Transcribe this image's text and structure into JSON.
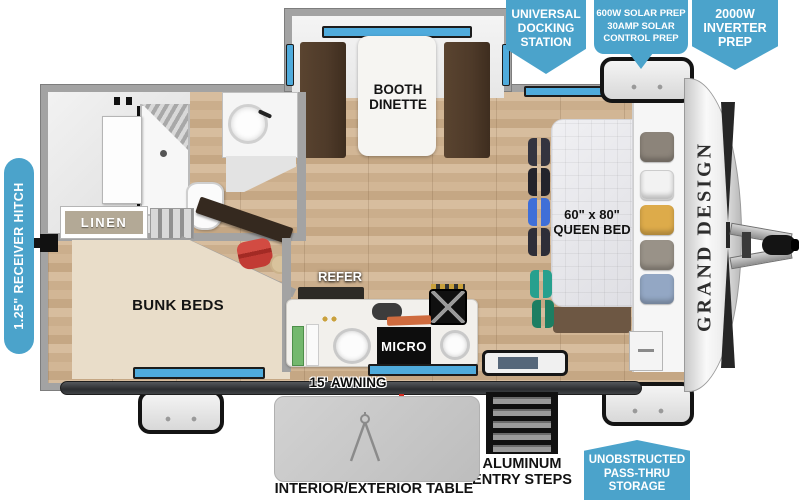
{
  "colors": {
    "callout_blue": "#4BA3CB",
    "window_blue": "#4FABDC",
    "wood_floor": "#D0B493",
    "bunk_beige": "#E9DDC9",
    "bench_brown": "#4E3A29",
    "awning_dark": "#2B2D30"
  },
  "callouts": {
    "docking": {
      "lines": [
        "UNIVERSAL",
        "DOCKING",
        "STATION"
      ]
    },
    "solar": {
      "lines": [
        "600W SOLAR PREP",
        "30AMP SOLAR",
        "CONTROL PREP"
      ]
    },
    "inverter": {
      "lines": [
        "2000W",
        "INVERTER",
        "PREP"
      ]
    },
    "receiver_hitch": {
      "label": "1.25\" RECEIVER HITCH"
    },
    "passthru": {
      "lines": [
        "UNOBSTRUCTED",
        "PASS-THRU",
        "STORAGE"
      ]
    }
  },
  "rooms": {
    "dinette": {
      "lines": [
        "BOOTH",
        "DINETTE"
      ]
    },
    "linen": {
      "label": "LINEN"
    },
    "bunks": {
      "label": "BUNK BEDS"
    },
    "kitchen": {
      "refer": "REFER",
      "micro": "MICRO"
    },
    "bedroom": {
      "lines": [
        "60\" x 80\"",
        "QUEEN BED"
      ]
    }
  },
  "exterior": {
    "awning": "15' AWNING",
    "lp": {
      "lines": [
        "LP QUICK",
        "CONNECT"
      ]
    },
    "steps": {
      "lines": [
        "ALUMINUM",
        "ENTRY STEPS"
      ]
    },
    "table": "INTERIOR/EXTERIOR TABLE",
    "brand": "GRAND DESIGN"
  }
}
